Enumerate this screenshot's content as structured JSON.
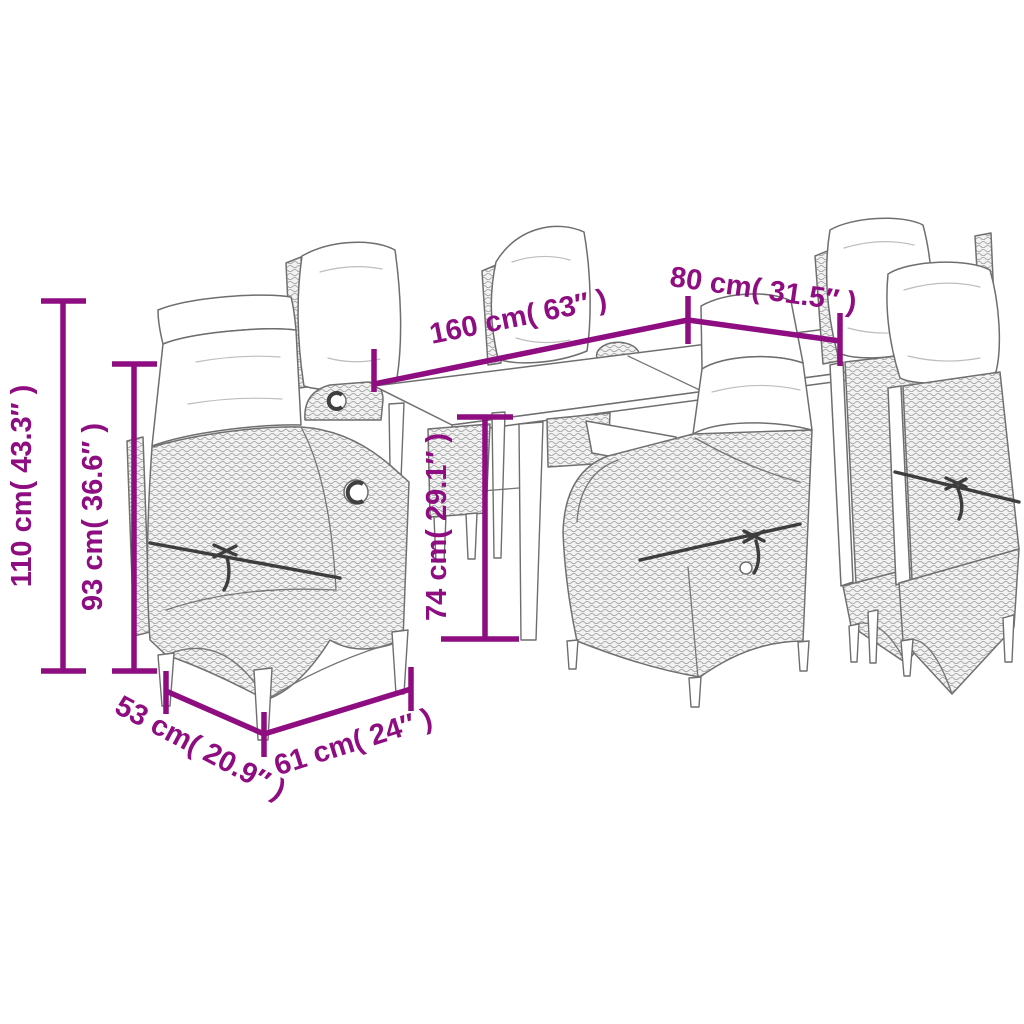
{
  "scene": {
    "subject": "line drawing of a garden dining set: rectangular table with six high-back rattan recliner chairs with cushions"
  },
  "colors": {
    "annotation": "#8E0D81",
    "line_art": "#6e6e6e",
    "background": "#ffffff"
  },
  "dimensions": {
    "chair_height": {
      "label": "110 cm( 43.3″ )",
      "value_cm": 110,
      "value_inch": 43.3
    },
    "backrest_height": {
      "label": "93 cm( 36.6″ )",
      "value_cm": 93,
      "value_inch": 36.6
    },
    "table_length": {
      "label": "160 cm( 63″ )",
      "value_cm": 160,
      "value_inch": 63
    },
    "table_width": {
      "label": "80 cm( 31.5″ )",
      "value_cm": 80,
      "value_inch": 31.5
    },
    "table_height": {
      "label": "74 cm( 29.1″ )",
      "value_cm": 74,
      "value_inch": 29.1
    },
    "chair_depth": {
      "label": "53 cm( 20.9″ )",
      "value_cm": 53,
      "value_inch": 20.9
    },
    "chair_width": {
      "label": "61 cm( 24″ )",
      "value_cm": 61,
      "value_inch": 24
    }
  }
}
